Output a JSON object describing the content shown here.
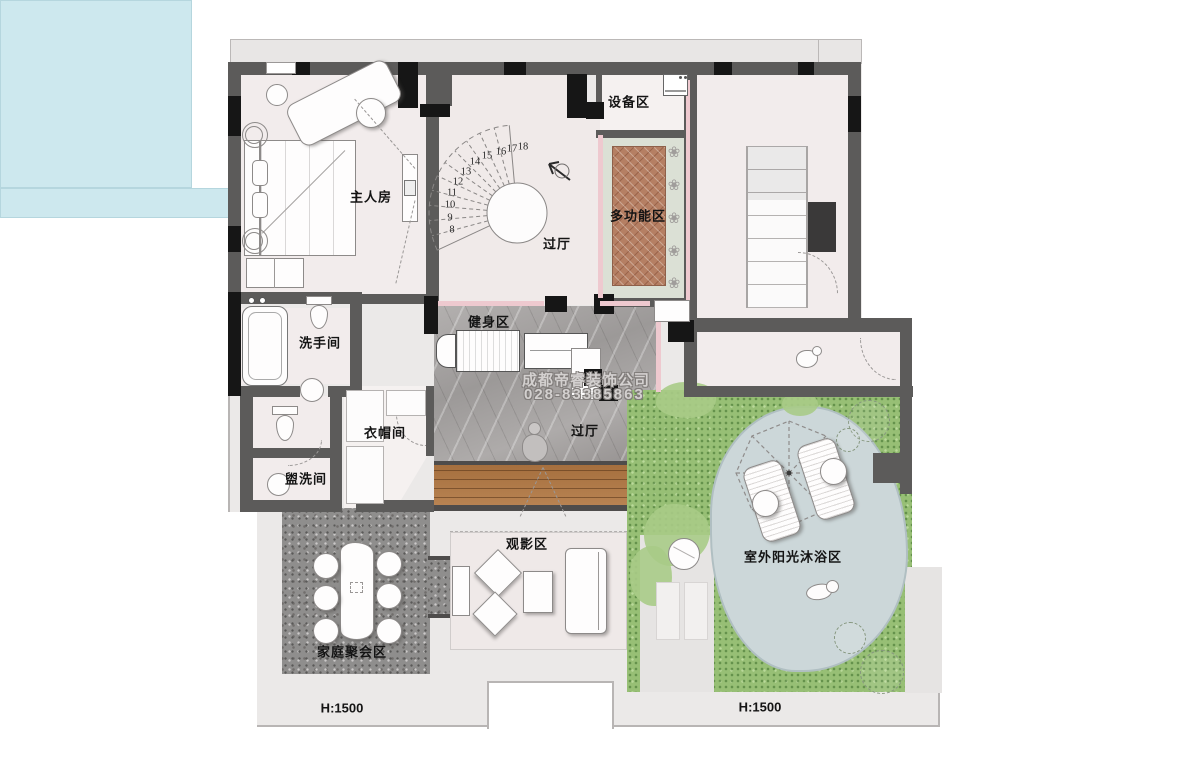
{
  "plan": {
    "company_watermark": "成都帝睿装饰公司",
    "phone_watermark": "028-83385863",
    "rooms": {
      "master_bedroom": "主人房",
      "foyer": "过厅",
      "equipment_zone": "设备区",
      "multifunction_zone": "多功能区",
      "bathroom": "洗手间",
      "fitness_zone": "健身区",
      "cloakroom": "衣帽间",
      "washroom": "盥洗间",
      "cinema_zone": "观影区",
      "family_gathering_zone": "家庭聚会区",
      "outdoor_sunbathing_zone": "室外阳光沐浴区"
    },
    "stair_numbers": [
      "8",
      "9",
      "10",
      "11",
      "12",
      "13",
      "14",
      "15",
      "16",
      "17",
      "18"
    ],
    "height_marks": {
      "left": "H:1500",
      "right": "H:1500"
    },
    "icons": {
      "flower": "❀"
    }
  }
}
